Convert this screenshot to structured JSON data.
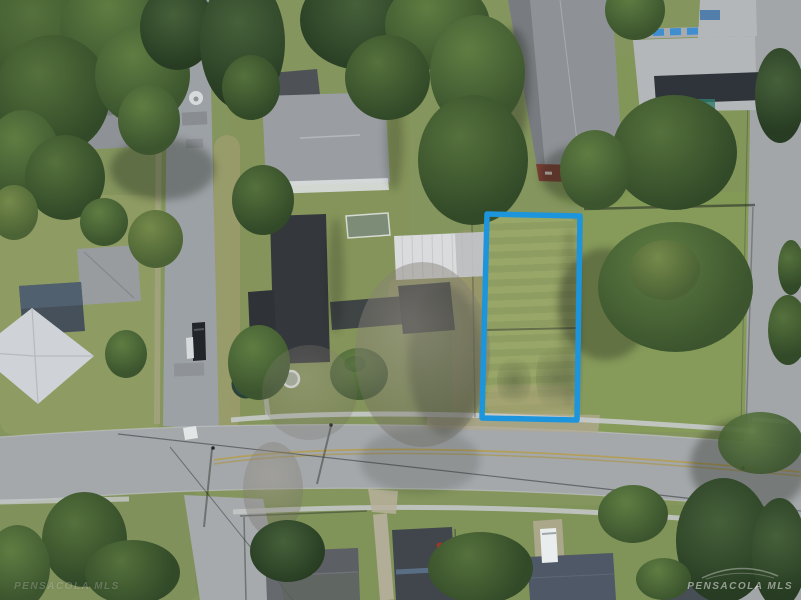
{
  "lot": {
    "label": "highlighted property boundary",
    "boundary_points": "487,214 580,216 577,420 482,418",
    "stroke_color": "#1d95dc",
    "stroke_width": "5.5"
  },
  "watermark": {
    "text": "PENSACOLA MLS"
  }
}
